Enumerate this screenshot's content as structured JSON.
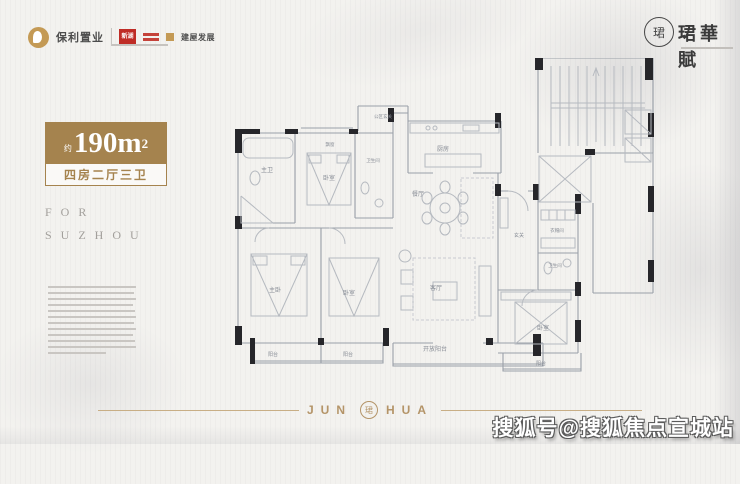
{
  "header": {
    "logos": {
      "poly": {
        "label": "保利置业"
      },
      "xinhu": {
        "label": "新湖"
      },
      "jianwu": {
        "label": "建屋发展"
      }
    },
    "brand": {
      "name": "珺華賦",
      "seal_char": "珺"
    }
  },
  "hero": {
    "area_prefix": "约",
    "area_value": "190m",
    "area_sup": "2",
    "layout_text": "四房二厅三卫",
    "slogan_line1": "FOR",
    "slogan_line2": "SUZHOU"
  },
  "floorplan": {
    "labels": [
      {
        "text": "公区玄关"
      },
      {
        "text": "厨房"
      },
      {
        "text": "餐厅"
      },
      {
        "text": "客厅"
      },
      {
        "text": "开放阳台"
      },
      {
        "text": "主卫"
      },
      {
        "text": "飘窗"
      },
      {
        "text": "卧室"
      },
      {
        "text": "卫生间"
      },
      {
        "text": "主卧"
      },
      {
        "text": "卧室"
      },
      {
        "text": "阳台"
      },
      {
        "text": "阳台"
      },
      {
        "text": "玄关"
      },
      {
        "text": "衣帽间"
      },
      {
        "text": "卫生间"
      },
      {
        "text": "卧室"
      },
      {
        "text": "阳台"
      }
    ]
  },
  "footer": {
    "brand_left": "JUN",
    "brand_right": "HUA",
    "seal_char": "珺",
    "watermark": "搜狐号@搜狐焦点宣城站"
  },
  "colors": {
    "gold": "#a5834e",
    "gold_light": "#b49468",
    "logo_red": "#bf2c26",
    "wall_dark": "#26262a",
    "wall_light": "#9aa0a8"
  }
}
